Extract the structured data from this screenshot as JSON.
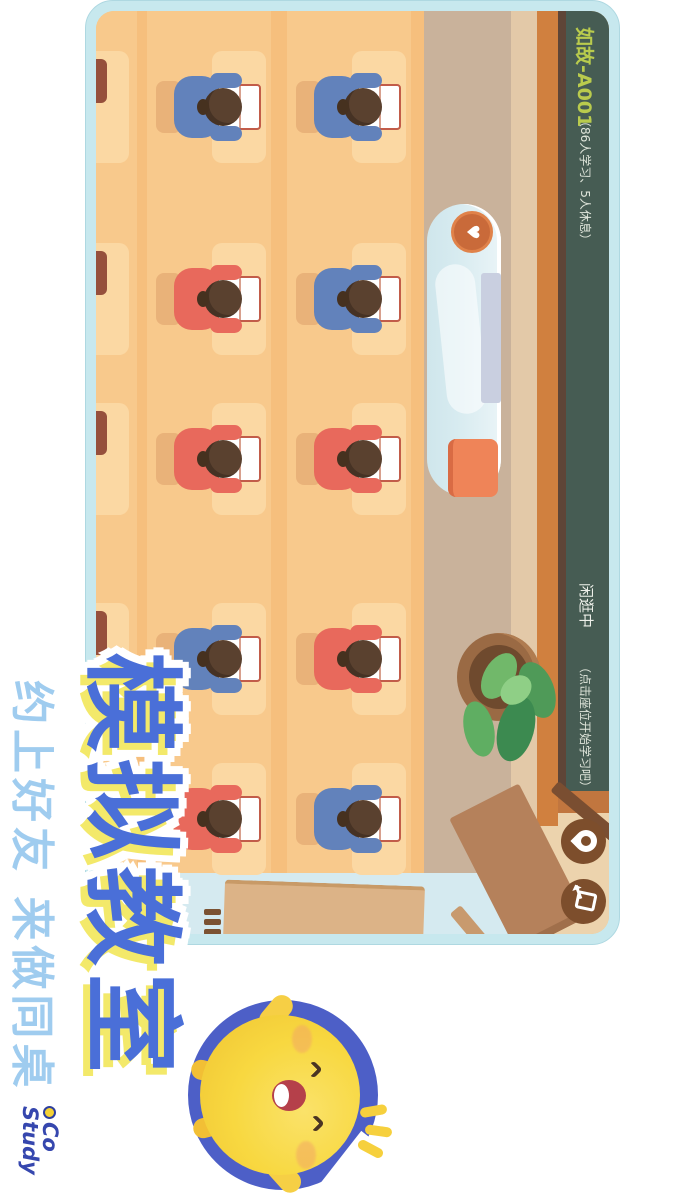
{
  "window": {
    "background": "#ffffff"
  },
  "game": {
    "frame_color": "#c7e8ee",
    "blackboard": {
      "board_color": "#465c53",
      "room_name": "如故-A001",
      "room_name_color": "#b9cb4d",
      "stats": "（86人学习、5人休息）",
      "status": "闲逛中",
      "hint": "（点击座位开始学习吧）",
      "text_color": "#eef0ea"
    },
    "toolbar": {
      "button_color": "#7d4e2c",
      "buttons": [
        {
          "label": "locate",
          "icon": "map-pin-icon"
        },
        {
          "label": "exit",
          "icon": "exit-door-icon"
        }
      ]
    },
    "classroom": {
      "floor_color": "#f6bf7d",
      "desk_color": "#fbd8a3",
      "corridor_color": "#d5eaf0",
      "shirt_colors": {
        "blue": "#6282bb",
        "red": "#e8695c"
      },
      "desk_columns_x": [
        40,
        232,
        392,
        592,
        752
      ],
      "rows": [
        {
          "name": "front-row",
          "students": [
            "blue",
            "blue",
            "red",
            "red",
            "blue"
          ]
        },
        {
          "name": "middle-row",
          "students": [
            "blue",
            "red",
            "red",
            "blue",
            "red"
          ]
        },
        {
          "name": "back-row-partial",
          "students": []
        }
      ],
      "podium": {
        "heart_icon": "♥",
        "cushion_color": "#ef8458"
      }
    }
  },
  "promo": {
    "title": "模拟教室",
    "title_color": "#4a6fd8",
    "title_shadow_color": "#f3e96a",
    "subtitle": "约上好友 来做同桌",
    "subtitle_color": "#9fccef",
    "logo_line1": "Co",
    "logo_line2": "Study",
    "logo_color": "#3647ae",
    "mascot": {
      "body_color": "#f8d840",
      "ring_color": "#4d5fc7"
    }
  }
}
